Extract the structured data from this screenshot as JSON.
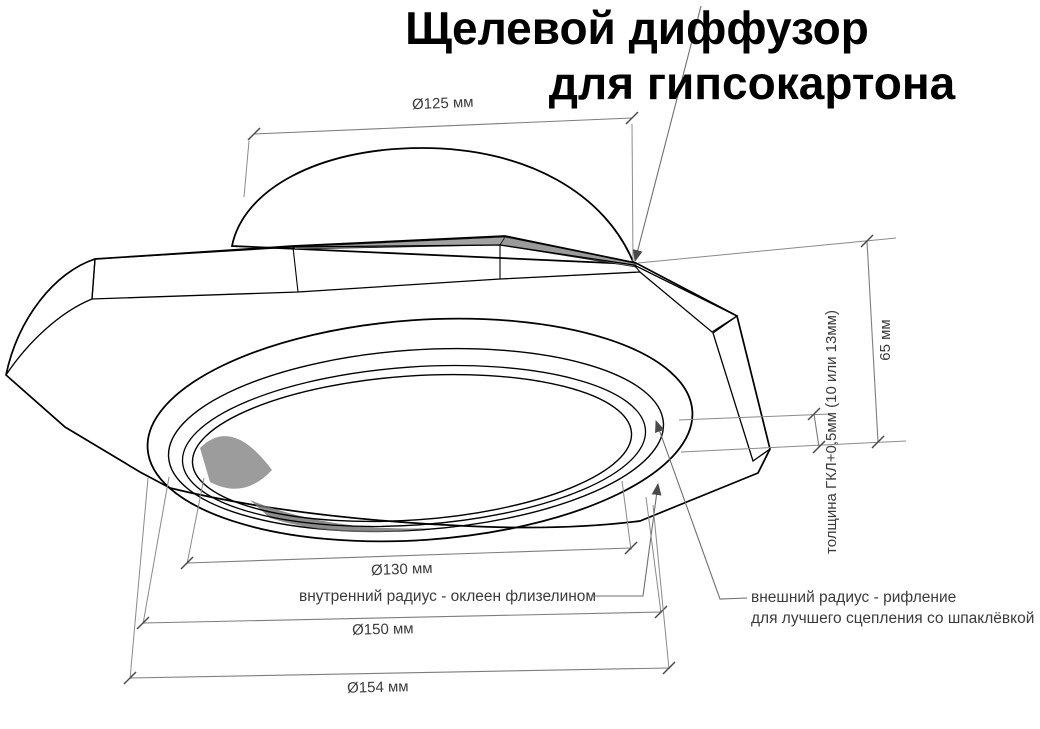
{
  "title": {
    "line1": "Щелевой диффузор",
    "line2": "для гипсокартона"
  },
  "dims": {
    "d125": "Ø125 мм",
    "h65": "65 мм",
    "thickness": "толщина ГКЛ+0,5мм (10 или 13мм)",
    "d130": "Ø130 мм",
    "d150": "Ø150 мм",
    "d154": "Ø154 мм"
  },
  "notes": {
    "inner": "внутренний радиус - оклеен флизелином",
    "outer1": "внешний радиус - рифление",
    "outer2": "для лучшего сцепления со шпаклёвкой"
  },
  "colors": {
    "line": "#000000",
    "dimension": "#7d7d7d",
    "plate_gray": "#b3b3b3",
    "slot_dark": "#1f1f1f"
  }
}
